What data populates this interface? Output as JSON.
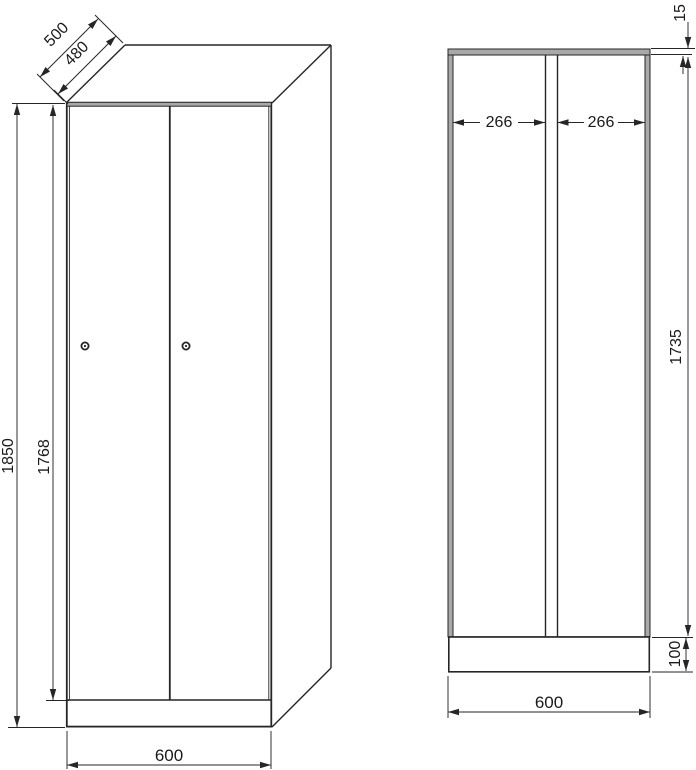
{
  "colors": {
    "line": "#262626",
    "panel_fill": "#a9a9a9",
    "background": "#ffffff",
    "dim_text": "#1a1a1a"
  },
  "front_view": {
    "dims": {
      "depth": "500",
      "door_depth": "480",
      "total_height": "1850",
      "door_height": "1768",
      "width": "600"
    },
    "icons": {
      "left_door_lock": "keyhole-icon",
      "right_door_lock": "keyhole-icon"
    }
  },
  "section_view": {
    "dims": {
      "top_panel_thickness": "15",
      "left_inner_width": "266",
      "right_inner_width": "266",
      "inner_height": "1735",
      "base_height": "100",
      "width": "600"
    }
  }
}
